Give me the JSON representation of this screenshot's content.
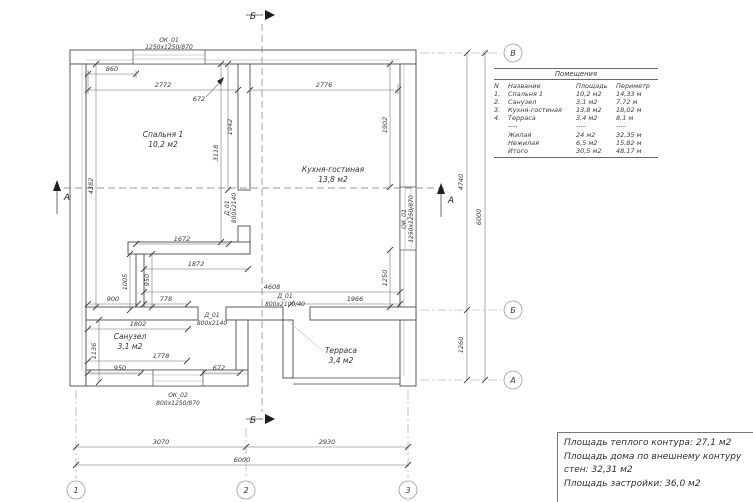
{
  "plan": {
    "axes": {
      "col1": "1",
      "col2": "2",
      "col3": "3",
      "row_a": "А",
      "row_b": "Б",
      "row_v": "В"
    },
    "sections": {
      "a": "А",
      "b": "Б"
    },
    "rooms": {
      "bedroom": {
        "name": "Спальня 1",
        "area": "10,2 м2"
      },
      "kitchen": {
        "name": "Кухня-гостиная",
        "area": "13,8 м2"
      },
      "bathroom": {
        "name": "Санузел",
        "area": "3,1 м2"
      },
      "terrace": {
        "name": "Терраса",
        "area": "3,4 м2"
      }
    },
    "openings": {
      "window_top": {
        "code": "ОК_01",
        "size": "1250х1250/870"
      },
      "window_right": {
        "code": "ОК_01",
        "size": "1250х1250/870"
      },
      "window_bottom": {
        "code": "ОК_02",
        "size": "800х1250/870"
      },
      "door_bedroom": {
        "code": "Д_01",
        "size": "800х2140"
      },
      "door_bathroom": {
        "code": "Д_01",
        "size": "800х2140"
      },
      "door_terrace": {
        "code": "Д_01",
        "size": "800х2100/40"
      }
    },
    "dims": {
      "top_window_offset": "860",
      "bedroom_width": "2772",
      "window_to_wall": "672",
      "kitchen_width": "2776",
      "left_height": "4382",
      "bedroom_wall_upper": "1942",
      "bedroom_wall_full": "3118",
      "right_upper": "1902",
      "right_lower": "1250",
      "hall_1672": "1672",
      "hall_1872": "1872",
      "hall_950": "950",
      "hall_1005": "1005",
      "hall_900": "900",
      "hall_778": "778",
      "hall_1802": "1802",
      "kitchen_4608": "4608",
      "terrace_1966": "1966",
      "bath_1136": "1136",
      "bath_1778": "1778",
      "bath_950": "950",
      "bath_672": "672",
      "grid_3070": "3070",
      "grid_2930": "2930",
      "grid_6000_bottom": "6000",
      "grid_4740": "4740",
      "grid_1260": "1260",
      "grid_6000_right": "6000"
    }
  },
  "rooms_table": {
    "title": "Помещения",
    "headers": [
      "N",
      "Название",
      "Площадь",
      "Периметр"
    ],
    "rows": [
      {
        "n": "1.",
        "name": "Спальня 1",
        "area": "10,2 м2",
        "perimeter": "14,33 м"
      },
      {
        "n": "2.",
        "name": "Санузел",
        "area": "3,1 м2",
        "perimeter": "7,72 м"
      },
      {
        "n": "3.",
        "name": "Кухня-гостиная",
        "area": "13,8 м2",
        "perimeter": "18,02 м"
      },
      {
        "n": "4.",
        "name": "Терраса",
        "area": "3,4 м2",
        "perimeter": "8,1 м"
      }
    ],
    "separator": "----",
    "totals": [
      {
        "name": "Жилая",
        "area": "24 м2",
        "perimeter": "32,35 м"
      },
      {
        "name": "Нежилая",
        "area": "6,5 м2",
        "perimeter": "15,82 м"
      },
      {
        "name": "Итого",
        "area": "30,5 м2",
        "perimeter": "48,17 м"
      }
    ]
  },
  "summary": {
    "lines": [
      "Площадь теплого контура: 27,1 м2",
      "Площадь дома по внешнему контуру стен: 32,31 м2",
      "Площадь застройки: 36,0 м2"
    ]
  }
}
